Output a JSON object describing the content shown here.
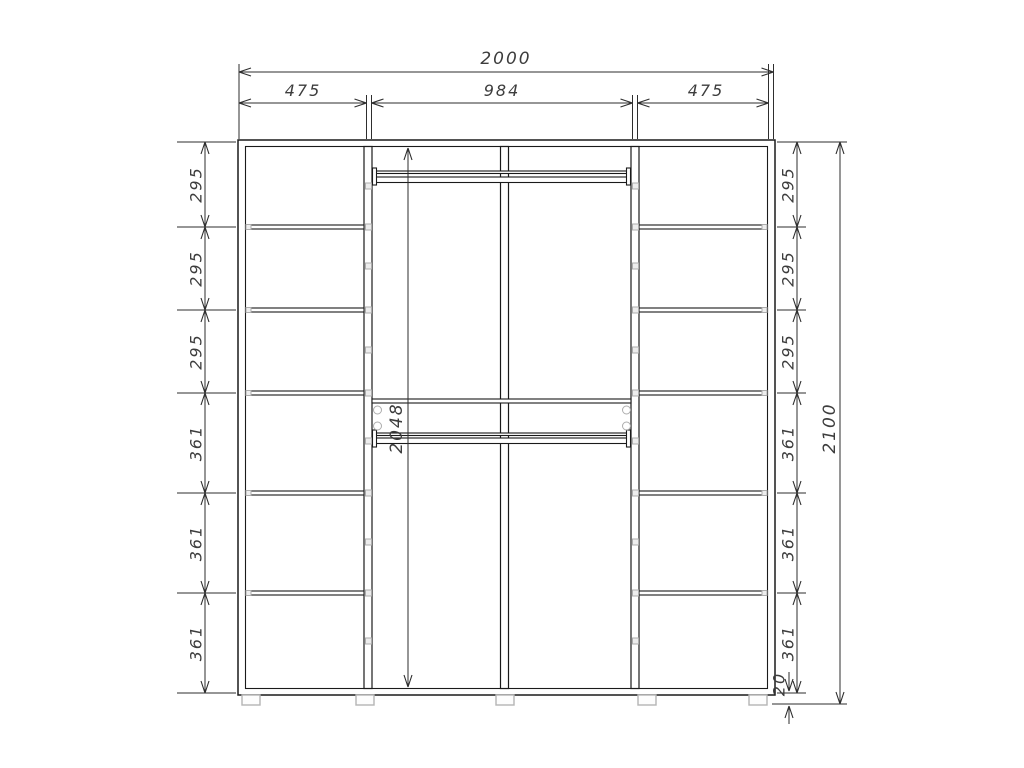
{
  "dimensions": {
    "overall_width": "2000",
    "section_widths": [
      "475",
      "984",
      "475"
    ],
    "left_compartments": [
      "295",
      "295",
      "295",
      "361",
      "361",
      "361"
    ],
    "right_compartments": [
      "295",
      "295",
      "295",
      "361",
      "361",
      "361"
    ],
    "overall_height": "2100",
    "center_interior_height": "2048",
    "base_height": "20"
  },
  "colors": {
    "background": "#ffffff",
    "cabinet_line": "#1a1a1a",
    "dimension_line": "#2e2e2e",
    "dimension_text": "#3d3d3d",
    "fitting_gray": "#adadad",
    "foot_gray": "#b5b5b5"
  }
}
